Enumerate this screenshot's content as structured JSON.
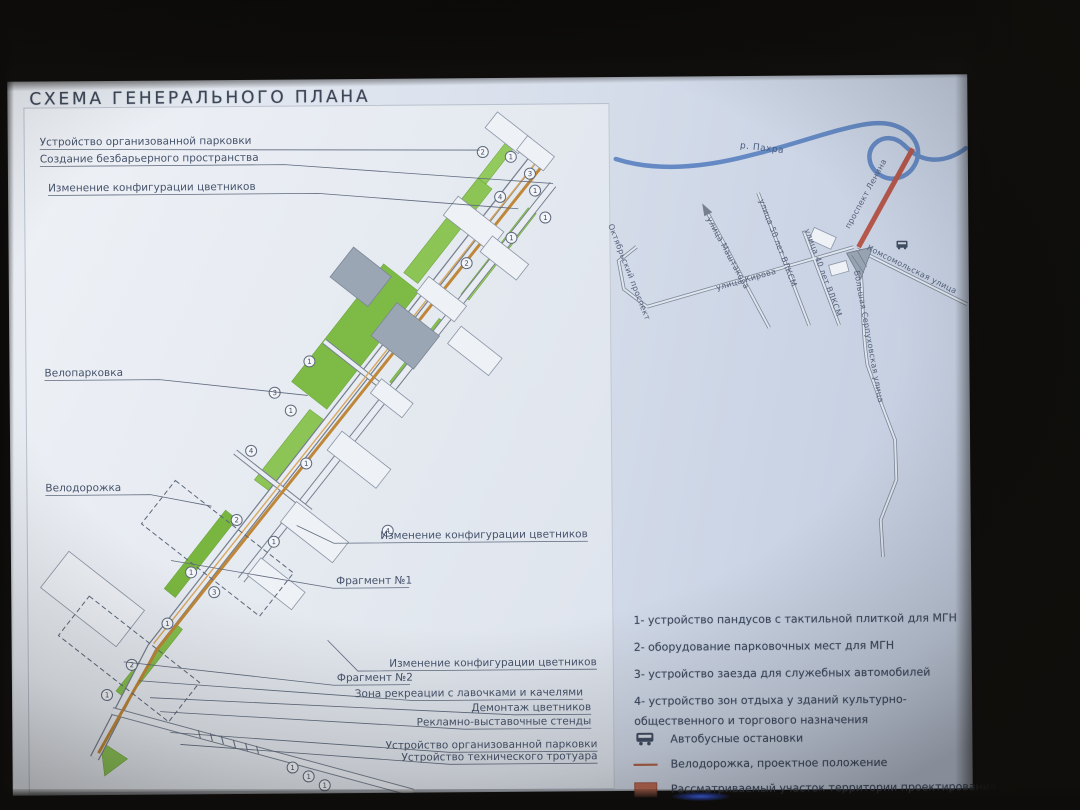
{
  "slide": {
    "title": "СХЕМА ГЕНЕРАЛЬНОГО ПЛАНА"
  },
  "plan": {
    "labels_left": [
      "Устройство организованной парковки",
      "Создание безбарьерного пространства",
      "Изменение  конфигурации цветников",
      "Велопарковка",
      "Велодорожка"
    ],
    "labels_right": [
      "Изменение  конфигурации цветников",
      "Фрагмент №1",
      "Изменение  конфигурации цветников",
      "Фрагмент №2",
      "Зона рекреации с лавочками и качелями",
      "Демонтаж цветников",
      "Рекламно-выставочные стенды",
      "Устройство организованной парковки",
      "Устройство технического тротуара"
    ],
    "markers": [
      {
        "x": 475,
        "y": 74,
        "n": "2"
      },
      {
        "x": 503,
        "y": 79,
        "n": "1"
      },
      {
        "x": 522,
        "y": 96,
        "n": "3"
      },
      {
        "x": 527,
        "y": 113,
        "n": "1"
      },
      {
        "x": 492,
        "y": 119,
        "n": "4"
      },
      {
        "x": 537,
        "y": 140,
        "n": "1"
      },
      {
        "x": 503,
        "y": 160,
        "n": "1"
      },
      {
        "x": 458,
        "y": 185,
        "n": "2"
      },
      {
        "x": 300,
        "y": 282,
        "n": "1"
      },
      {
        "x": 265,
        "y": 313,
        "n": "3"
      },
      {
        "x": 281,
        "y": 331,
        "n": "1"
      },
      {
        "x": 241,
        "y": 371,
        "n": "4"
      },
      {
        "x": 296,
        "y": 384,
        "n": "1"
      },
      {
        "x": 226,
        "y": 440,
        "n": "2"
      },
      {
        "x": 263,
        "y": 462,
        "n": "1"
      },
      {
        "x": 377,
        "y": 452,
        "n": "4"
      },
      {
        "x": 180,
        "y": 492,
        "n": "1"
      },
      {
        "x": 203,
        "y": 512,
        "n": "3"
      },
      {
        "x": 156,
        "y": 543,
        "n": "1"
      },
      {
        "x": 120,
        "y": 584,
        "n": "2"
      },
      {
        "x": 95,
        "y": 614,
        "n": "1"
      },
      {
        "x": 280,
        "y": 688,
        "n": "1"
      },
      {
        "x": 296,
        "y": 697,
        "n": "1"
      },
      {
        "x": 312,
        "y": 706,
        "n": "1"
      }
    ]
  },
  "map": {
    "river_label": "р. Пахра",
    "streets": {
      "oktyabrsky": "Октябрьский проспект",
      "kirova": "улица Кирова",
      "mashtakova": "улица Маштакова",
      "vlksm50": "улица 50 лет ВЛКСМ",
      "vlksm40": "улица 40 лет ВЛКСМ",
      "komsomolskaya": "Комсомольская улица",
      "serpukhovskaya": "Большая Серпуховская улица",
      "lenina": "проспект Ленина"
    }
  },
  "notes": {
    "items": [
      "1- устройство пандусов с тактильной плиткой для МГН",
      "2- оборудование парковочных мест для МГН",
      "3- устройство заезда для служебных автомобилей",
      "4- устройство зон отдыха у зданий  культурно-общественного и торгового назначения"
    ]
  },
  "legend": {
    "items": [
      {
        "icon": "bus-icon",
        "label": "Автобусные остановки"
      },
      {
        "icon": "bike-line-icon",
        "label": "Велодорожка, проектное положение"
      },
      {
        "icon": "area-swatch-icon",
        "label": "Рассматриваемый участок территории проектирования"
      }
    ]
  },
  "colors": {
    "project_red": "#b5574b",
    "bike_path": "#bf8737",
    "greenery": "#86bf4f",
    "river": "#5b82c0",
    "slide_bg": "#d8dfec",
    "ink": "#46536b"
  }
}
